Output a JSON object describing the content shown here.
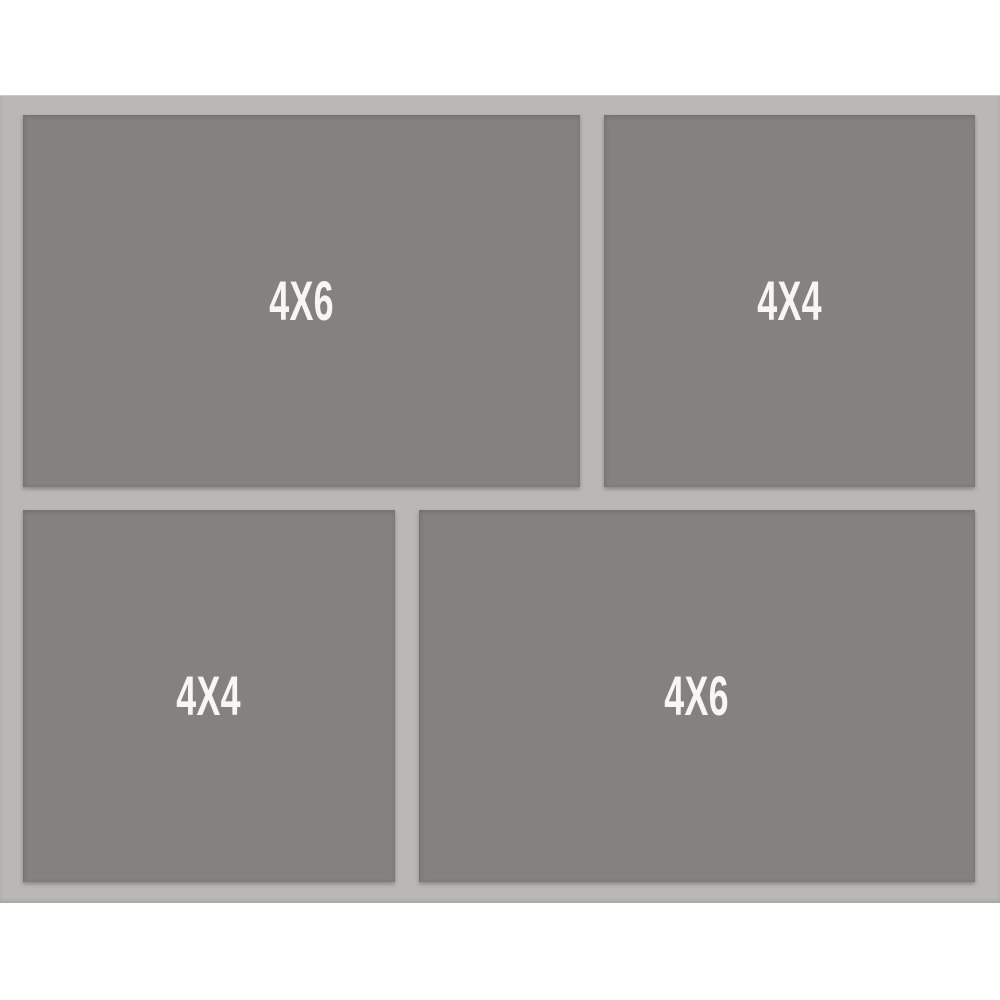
{
  "colors": {
    "background": "#ffffff",
    "mat": "#b9b8b5",
    "opening": "#848280",
    "label": "#f7f6f3"
  },
  "collage": {
    "openings": [
      {
        "label": "4X6",
        "position": "top-left"
      },
      {
        "label": "4X4",
        "position": "top-right"
      },
      {
        "label": "4X4",
        "position": "bottom-left"
      },
      {
        "label": "4X6",
        "position": "bottom-right"
      }
    ]
  }
}
